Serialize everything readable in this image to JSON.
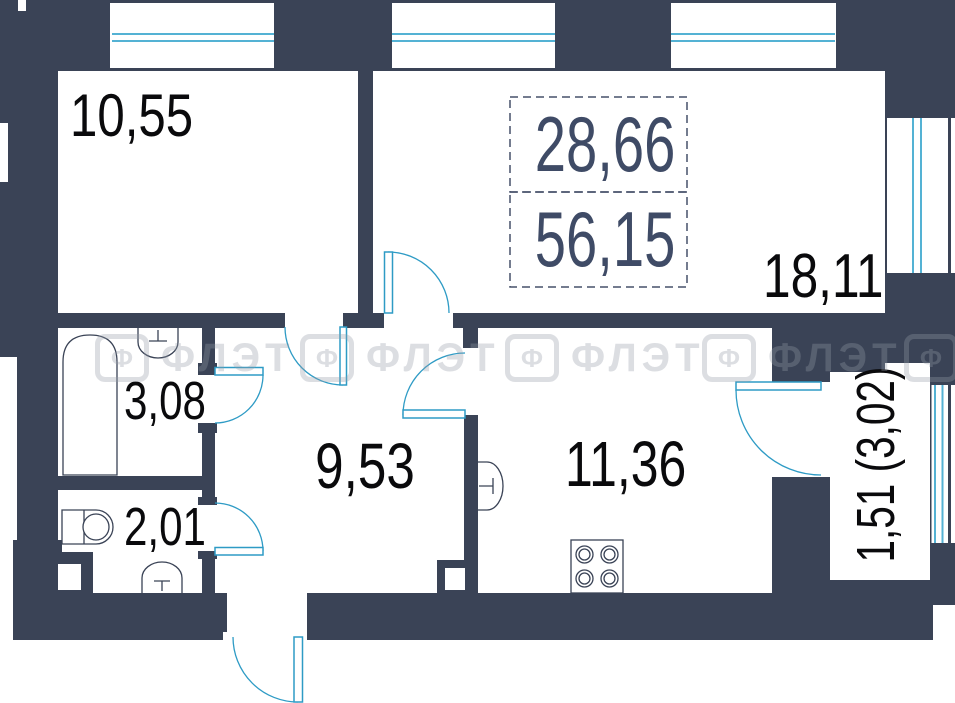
{
  "title": "Apartment floor plan",
  "plan": {
    "summary": {
      "living_area": "28,66",
      "total_area": "56,15"
    },
    "rooms": {
      "bedroom": {
        "label": "10,55"
      },
      "living_room": {
        "label": "18,11"
      },
      "bathroom": {
        "label": "3,08"
      },
      "wc": {
        "label": "2,01"
      },
      "hall": {
        "label": "9,53"
      },
      "kitchen": {
        "label": "11,36"
      },
      "balcony": {
        "label": "1,51 (3,02)"
      }
    },
    "watermark": {
      "logo_letter": "Ф",
      "text": "ФЛЭТ"
    },
    "colors": {
      "wall": "#3A4356",
      "glazing": "#54B2D4",
      "door": "#2E9BC5",
      "room_text": "#0A0A0C",
      "summary_text": "#3F4B66"
    }
  }
}
